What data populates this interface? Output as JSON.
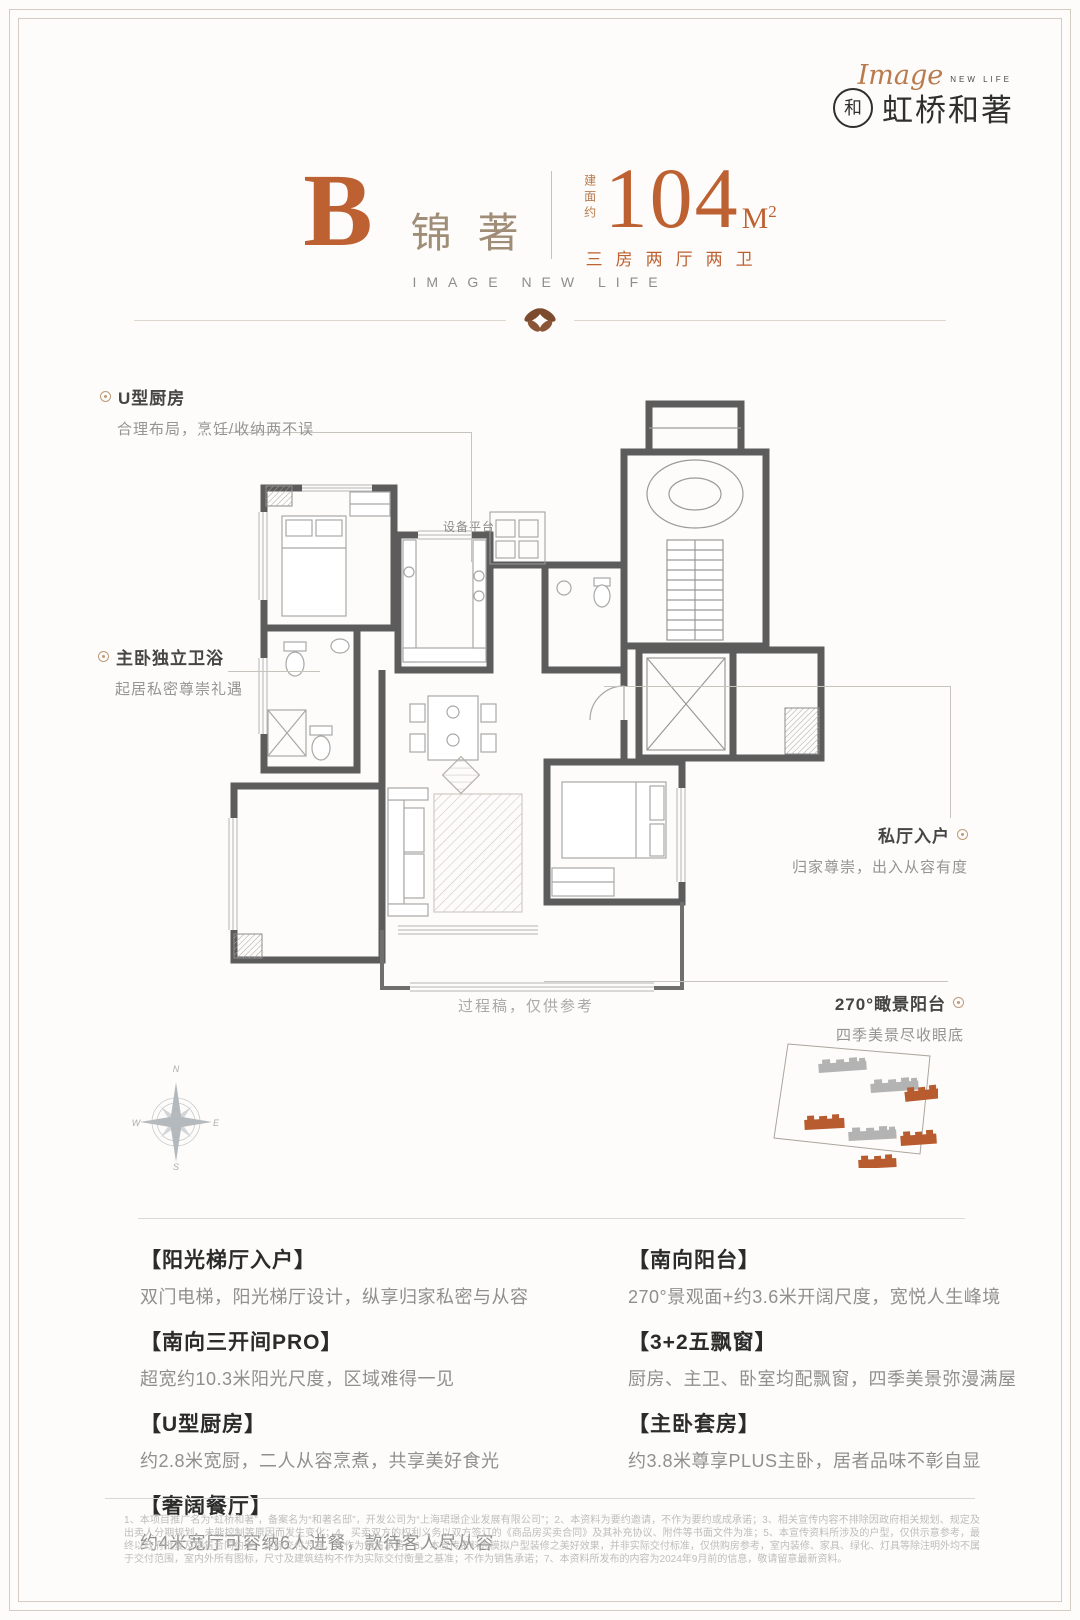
{
  "brand": {
    "script": "Image",
    "script_sub": "NEW LIFE",
    "name": "虹桥和著",
    "seal_char": "和"
  },
  "title": {
    "unit": "B",
    "unit_name": "锦著",
    "area_prefix": "建面约",
    "area_value": "104",
    "area_unit": "M",
    "area_sup": "2",
    "layout_tags": "三房两厅两卫",
    "slogan": "IMAGE NEW LIFE"
  },
  "plan": {
    "equipment_label": "设备平台",
    "draft_note": "过程稿，仅供参考"
  },
  "callouts": {
    "kitchen": {
      "title": "U型厨房",
      "desc": "合理布局，烹饪/收纳两不误"
    },
    "master_bath": {
      "title": "主卧独立卫浴",
      "desc": "起居私密尊崇礼遇"
    },
    "private_hall": {
      "title": "私厅入户",
      "desc": "归家尊崇，出入从容有度"
    },
    "balcony": {
      "title": "270°瞰景阳台",
      "desc": "四季美景尽收眼底"
    }
  },
  "compass": {
    "n": "N",
    "e": "E",
    "s": "S",
    "w": "W"
  },
  "features": {
    "left": [
      {
        "title": "【阳光梯厅入户】",
        "desc": "双门电梯，阳光梯厅设计，纵享归家私密与从容"
      },
      {
        "title": "【南向三开间PRO】",
        "desc": "超宽约10.3米阳光尺度，区域难得一见"
      },
      {
        "title": "【U型厨房】",
        "desc": "约2.8米宽厨，二人从容烹煮，共享美好食光"
      },
      {
        "title": "【奢阔餐厅】",
        "desc": "约4米宽厅可容纳6人进餐，款待客人尽从容"
      }
    ],
    "right": [
      {
        "title": "【南向阳台】",
        "desc": "270°景观面+约3.6米开阔尺度，宽悦人生峰境"
      },
      {
        "title": "【3+2五飘窗】",
        "desc": "厨房、主卫、卧室均配飘窗，四季美景弥漫满屋"
      },
      {
        "title": "【主卧套房】",
        "desc": "约3.8米尊享PLUS主卧，居者品味不彰自显"
      }
    ]
  },
  "disclaimer": "1、本项目推广名为“虹桥和著”，备案名为“和著名邸”，开发公司为“上海珺璟企业发展有限公司”；2、本资料为要约邀请，不作为要约或成承诺；3、相关宣传内容不排除因政府相关规划、规定及出卖人分期规划、未能控制等原因而发生变化；4、买卖双方的权利义务以双方签订的《商品房买卖合同》及其补充协议、附件等书面文件为准；5、本宣传资料所涉及的户型，仅供示意参考，最终以政府批复及销售合同约定、实际交付为准，不作为销售承诺；6、本宣传资料为模拟户型装修之美好效果，并非实际交付标准，仅供购房参考，室内装修、家具、绿化、灯具等除注明外均不属于交付范围，室内外所有图标，尺寸及建筑结构不作为实际交付衡量之基准；不作为销售承诺；7、本资料所发布的内容为2024年9月前的信息，敬请留意最新资料。",
  "colors": {
    "accent": "#bd6133",
    "name_taupe": "#a08d77",
    "ink": "#2f2f2f",
    "muted": "#8f8f8f",
    "wall": "#5c5c5c",
    "site_orange": "#b85c30",
    "site_gray": "#b3b3b3"
  }
}
